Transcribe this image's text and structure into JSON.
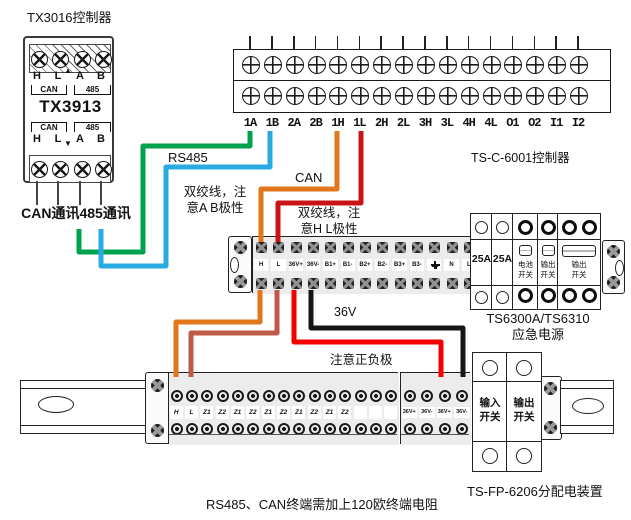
{
  "device": {
    "title": "TX3016控制器",
    "model": "TX3913",
    "row_top": {
      "labels": [
        "H",
        "L",
        "A",
        "B"
      ],
      "arrow": "▲",
      "brackets": [
        "CAN",
        "485"
      ]
    },
    "row_bottom": {
      "labels": [
        "H",
        "L",
        "A",
        "B"
      ],
      "arrow": "▼",
      "brackets": [
        "CAN",
        "485"
      ]
    },
    "caption": "CAN通讯485通讯"
  },
  "controller": {
    "label": "TS-C-6001控制器",
    "terminals": [
      "1A",
      "1B",
      "2A",
      "2B",
      "1H",
      "1L",
      "2H",
      "2L",
      "3H",
      "3L",
      "4H",
      "4L",
      "O1",
      "O2",
      "I1",
      "I2"
    ]
  },
  "mid_strip": {
    "terminals": [
      "H",
      "L",
      "36V+",
      "36V-",
      "B1+",
      "B1-",
      "B2+",
      "B2-",
      "B3+",
      "B3-",
      "⏚",
      "N",
      "L"
    ]
  },
  "psu": {
    "label": "TS6300A/TS6310\n应急电源",
    "fuses": [
      "25A",
      "25A"
    ],
    "switches": [
      {
        "label": "电池\n开关",
        "wide": false
      },
      {
        "label": "输出\n开关",
        "wide": false
      },
      {
        "label": "输出\n开关",
        "wide": true
      }
    ]
  },
  "dist": {
    "label": "TS-FP-6206分配电装置",
    "terminals": [
      "H",
      "L",
      "Z1",
      "Z2",
      "Z1",
      "Z2",
      "Z1",
      "Z2",
      "Z1",
      "Z2",
      "Z1",
      "Z2",
      "",
      "",
      ""
    ],
    "v36": [
      "36V+",
      "36V-",
      "36V+",
      "36V-"
    ],
    "switches": [
      "输入\n开关",
      "输出\n开关"
    ]
  },
  "notes": {
    "rs485": "RS485",
    "can": "CAN",
    "ab": "双绞线，注\n意A B极性",
    "hl": "双绞线，注\n意H L极性",
    "v36": "36V",
    "polarity": "注意正负极",
    "footer": "RS485、CAN终端需加上120欧终端电阻"
  },
  "wires": [
    {
      "name": "rs485-a-wire",
      "color": "#00A24D",
      "points": "79,229 79,252 143,252 143,146 250,146 250,131"
    },
    {
      "name": "rs485-b-wire",
      "color": "#29ABE2",
      "points": "101,229 101,266 166,266 166,167 270,167 270,131"
    },
    {
      "name": "can-h-wire",
      "color": "#E2761B",
      "points": "337,131 337,189 261,189 261,242"
    },
    {
      "name": "can-l-wire",
      "color": "#C81414",
      "points": "361,131 361,203 278,203 278,242"
    },
    {
      "name": "h-down-wire",
      "color": "#E2761B",
      "points": "260,290 260,322 176,322 176,377"
    },
    {
      "name": "l-down-wire",
      "color": "#C05A48",
      "points": "277,290 277,333 191,333 191,377"
    },
    {
      "name": "v36-plus-wire",
      "color": "#F40000",
      "points": "294,290 294,342 441,342 441,377"
    },
    {
      "name": "v36-minus-wire",
      "color": "#161616",
      "points": "311,290 311,328 463,328 463,377"
    }
  ]
}
